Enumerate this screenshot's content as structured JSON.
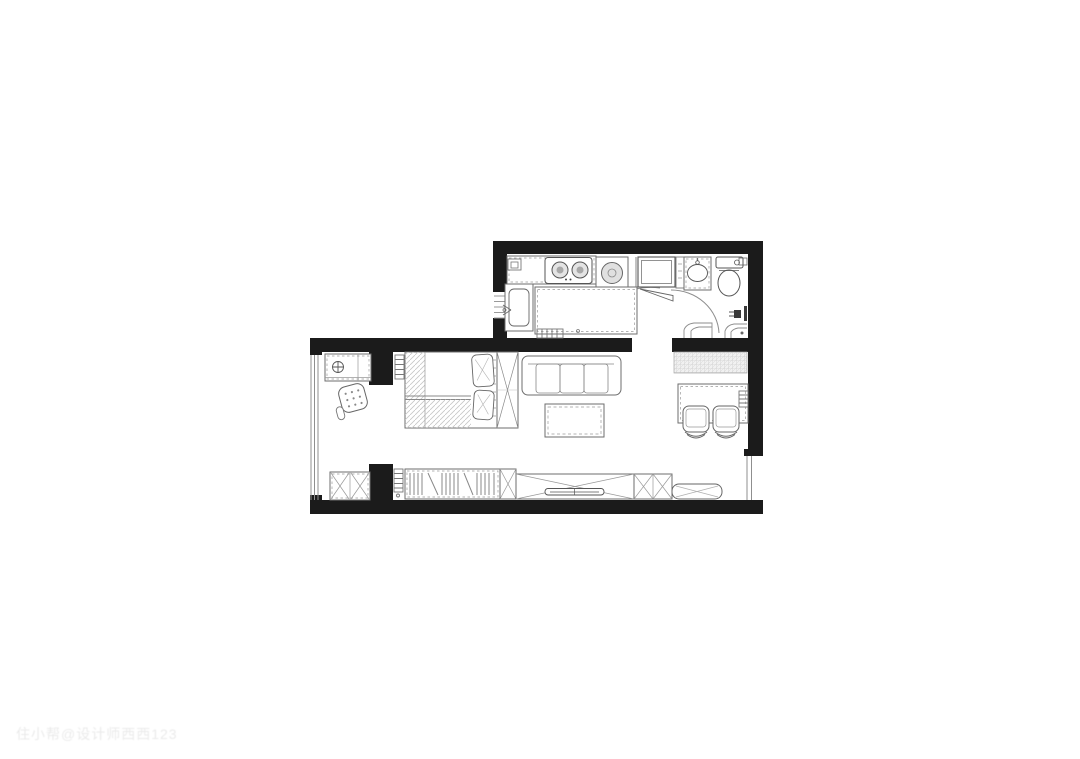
{
  "watermark": {
    "text": "住小帮@设计师西西123"
  },
  "palette": {
    "background": "#ffffff",
    "wall": "#1b1b1b",
    "furniture_line": "#6e6e6e",
    "detail_line": "#999999",
    "hatch": "#c6c6c6",
    "texture": "#c4c4c4",
    "appliance_fill": "#e0e0e0",
    "dark_fixture": "#3a3a3a",
    "watermark_text": "rgba(90,90,90,0.13)"
  },
  "floor_plan": {
    "type": "studio-apartment-floor-plan",
    "rooms": [
      "kitchen",
      "hallway",
      "bathroom",
      "entry",
      "bedroom-living-room",
      "dining-nook"
    ],
    "fixtures": [
      "kitchen-counter",
      "corner-cabinet",
      "cooktop-2-burner",
      "range-hood-controls",
      "washing-machine",
      "kitchen-sink",
      "kitchen-island",
      "radiator",
      "refrigerator",
      "partition-panel",
      "bathroom-vanity",
      "toilet",
      "paper-holder",
      "shower-mixer",
      "entry-door-swing",
      "bathroom-door-swing",
      "entry-step",
      "bathroom-step",
      "entry-cabinet",
      "floor-drain-symbol",
      "ottoman",
      "shoe-cabinet",
      "double-bed",
      "pillow",
      "blanket",
      "wardrobe",
      "sofa-3-seat",
      "coffee-table",
      "textured-sideboard",
      "dining-table",
      "dining-chair",
      "closet-hanging-rail",
      "storage-box",
      "tv-cabinet",
      "television",
      "bench",
      "window-left",
      "window-kitchen",
      "window-right"
    ]
  }
}
